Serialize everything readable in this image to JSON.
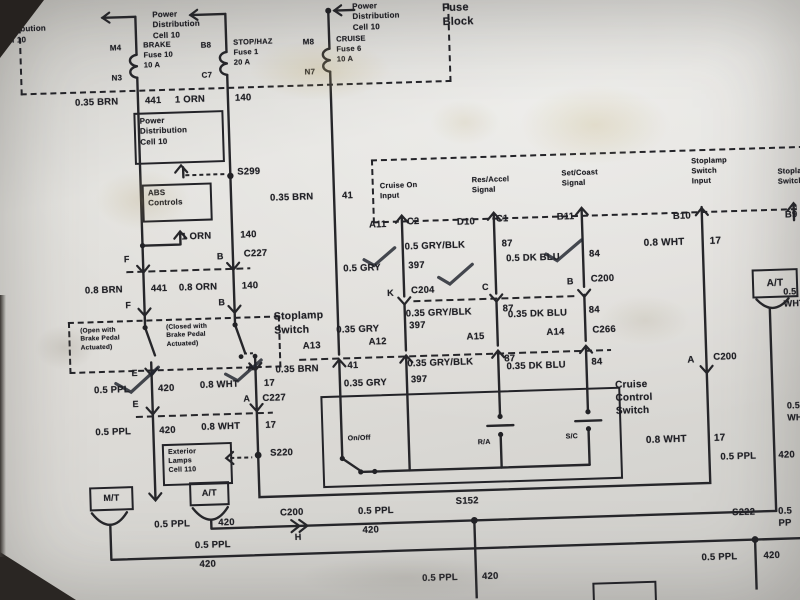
{
  "title": "Brake / Cruise Control wiring diagram photo",
  "boxes": {
    "pdc": "Power\nDistribution\nCell 10",
    "abs": "ABS\nControls",
    "ext": "Exterior\nLamps\nCell 110",
    "mt": "M/T",
    "at": "A/T",
    "at2": "A/T"
  },
  "labels": [
    {
      "n": "ref-power-dist-1",
      "t": "Power\nDistribution\nCell 10",
      "x": 8,
      "y": 2,
      "s": 8
    },
    {
      "n": "ref-power-dist-2",
      "t": "Power\nDistribution\nCell 10",
      "x": 162,
      "y": 2,
      "s": 8
    },
    {
      "n": "ref-power-dist-3",
      "t": "Power\nDistribution\nCell 10",
      "x": 362,
      "y": 0,
      "s": 8
    },
    {
      "n": "fuse-block-title",
      "t": "Fuse\nBlock",
      "x": 452,
      "y": 2,
      "s": 11
    },
    {
      "n": "pin-m4",
      "t": "M4",
      "x": 106,
      "y": 34,
      "s": 8,
      "a": "r",
      "w": 24
    },
    {
      "n": "fuse-brake",
      "t": "BRAKE\nFuse 10\n10 A",
      "x": 152,
      "y": 32,
      "s": 7.5
    },
    {
      "n": "pin-n3",
      "t": "N3",
      "x": 106,
      "y": 64,
      "s": 8,
      "a": "r",
      "w": 24
    },
    {
      "n": "pin-b8",
      "t": "B8",
      "x": 196,
      "y": 34,
      "s": 8,
      "a": "r",
      "w": 24
    },
    {
      "n": "fuse-stophaz",
      "t": "STOP/HAZ\nFuse 1\n20 A",
      "x": 242,
      "y": 32,
      "s": 7.5
    },
    {
      "n": "pin-c7",
      "t": "C7",
      "x": 196,
      "y": 64,
      "s": 8,
      "a": "r",
      "w": 24
    },
    {
      "n": "pin-m8",
      "t": "M8",
      "x": 299,
      "y": 34,
      "s": 8,
      "a": "r",
      "w": 24
    },
    {
      "n": "fuse-cruise",
      "t": "CRUISE\nFuse 6\n10 A",
      "x": 345,
      "y": 32,
      "s": 7.5
    },
    {
      "n": "pin-n7",
      "t": "N7",
      "x": 299,
      "y": 64,
      "s": 8,
      "a": "r",
      "w": 24
    },
    {
      "n": "wire-brn-035-441",
      "t": "0.35 BRN",
      "x": 82,
      "y": 87,
      "s": 9.5
    },
    {
      "n": "cir-441-a",
      "t": "441",
      "x": 152,
      "y": 87,
      "s": 9.5
    },
    {
      "n": "wire-orn-1a",
      "t": "1 ORN",
      "x": 182,
      "y": 87,
      "s": 9.5
    },
    {
      "n": "cir-140-a",
      "t": "140",
      "x": 242,
      "y": 87,
      "s": 9.5
    },
    {
      "n": "wire-brn-035-41a",
      "t": "0.35 BRN",
      "x": 274,
      "y": 188,
      "s": 9.5
    },
    {
      "n": "cir-41-a",
      "t": "41",
      "x": 346,
      "y": 188,
      "s": 9.5
    },
    {
      "n": "splice-s299",
      "t": "S299",
      "x": 242,
      "y": 161,
      "s": 9.5
    },
    {
      "n": "wire-orn-1b",
      "t": "1 ORN",
      "x": 184,
      "y": 224,
      "s": 9.5
    },
    {
      "n": "cir-140-b",
      "t": "140",
      "x": 243,
      "y": 224,
      "s": 9.5
    },
    {
      "n": "pin-f1",
      "t": "F",
      "x": 126,
      "y": 245,
      "s": 9
    },
    {
      "n": "pin-b1",
      "t": "B",
      "x": 219,
      "y": 245,
      "s": 9
    },
    {
      "n": "conn-c227-a",
      "t": "C227",
      "x": 246,
      "y": 243,
      "s": 9.5
    },
    {
      "n": "wire-brn-08",
      "t": "0.8 BRN",
      "x": 86,
      "y": 275,
      "s": 9.5
    },
    {
      "n": "cir-441-b",
      "t": "441",
      "x": 152,
      "y": 275,
      "s": 9.5
    },
    {
      "n": "wire-orn-08",
      "t": "0.8 ORN",
      "x": 180,
      "y": 275,
      "s": 9.5
    },
    {
      "n": "cir-140-c",
      "t": "140",
      "x": 243,
      "y": 275,
      "s": 9.5
    },
    {
      "n": "pin-f2",
      "t": "F",
      "x": 126,
      "y": 291,
      "s": 9
    },
    {
      "n": "pin-b2",
      "t": "B",
      "x": 219,
      "y": 291,
      "s": 9
    },
    {
      "n": "stoplamp-switch-title",
      "t": "Stoplamp\nSwitch",
      "x": 274,
      "y": 306,
      "s": 10.5
    },
    {
      "n": "note-open",
      "t": "(Open with\nBrake Pedal\nActuated)",
      "x": 80,
      "y": 317,
      "s": 6.5
    },
    {
      "n": "note-closed",
      "t": "(Closed with\nBrake Pedal\nActuated)",
      "x": 166,
      "y": 316,
      "s": 6.5
    },
    {
      "n": "pin-e1",
      "t": "E",
      "x": 130,
      "y": 359,
      "s": 9
    },
    {
      "n": "pin-a1",
      "t": "A",
      "x": 246,
      "y": 357,
      "s": 9
    },
    {
      "n": "wire-ppl-05a",
      "t": "0.5 PPL",
      "x": 92,
      "y": 375,
      "s": 9.5
    },
    {
      "n": "cir-420-a",
      "t": "420",
      "x": 156,
      "y": 375,
      "s": 9.5
    },
    {
      "n": "wire-wht-08a",
      "t": "0.8 WHT",
      "x": 198,
      "y": 373,
      "s": 9.5
    },
    {
      "n": "cir-17-a",
      "t": "17",
      "x": 262,
      "y": 373,
      "s": 9.5
    },
    {
      "n": "pin-e2",
      "t": "E",
      "x": 130,
      "y": 390,
      "s": 9
    },
    {
      "n": "pin-a2",
      "t": "A",
      "x": 241,
      "y": 388,
      "s": 9
    },
    {
      "n": "conn-c227-b",
      "t": "C227",
      "x": 260,
      "y": 388,
      "s": 9.5
    },
    {
      "n": "wire-ppl-05b",
      "t": "0.5 PPL",
      "x": 92,
      "y": 417,
      "s": 9.5
    },
    {
      "n": "cir-420-b",
      "t": "420",
      "x": 156,
      "y": 417,
      "s": 9.5
    },
    {
      "n": "wire-wht-08b",
      "t": "0.8 WHT",
      "x": 198,
      "y": 415,
      "s": 9.5
    },
    {
      "n": "cir-17-b",
      "t": "17",
      "x": 262,
      "y": 415,
      "s": 9.5
    },
    {
      "n": "splice-s220",
      "t": "S220",
      "x": 266,
      "y": 443,
      "s": 9.5
    },
    {
      "n": "input-cruise-on",
      "t": "Cruise On\nInput",
      "x": 384,
      "y": 180,
      "s": 7.5
    },
    {
      "n": "input-res-accel",
      "t": "Res/Accel\nSignal",
      "x": 476,
      "y": 177,
      "s": 7.5
    },
    {
      "n": "input-set-coast",
      "t": "Set/Coast\nSignal",
      "x": 566,
      "y": 173,
      "s": 7.5
    },
    {
      "n": "input-stoplamp",
      "t": "Stoplamp\nSwitch\nInput",
      "x": 696,
      "y": 165,
      "s": 7.5
    },
    {
      "n": "input-stoplamp-cut",
      "t": "Stoplamp\nSwitch",
      "x": 782,
      "y": 178,
      "s": 7.5
    },
    {
      "n": "pin-a11",
      "t": "A11",
      "x": 372,
      "y": 218,
      "s": 9.5
    },
    {
      "n": "pin-c2",
      "t": "C2",
      "x": 410,
      "y": 216,
      "s": 9.5
    },
    {
      "n": "pin-d10",
      "t": "D10",
      "x": 460,
      "y": 218,
      "s": 9.5
    },
    {
      "n": "pin-c1",
      "t": "C1",
      "x": 499,
      "y": 216,
      "s": 9.5
    },
    {
      "n": "pin-b11",
      "t": "B11",
      "x": 560,
      "y": 216,
      "s": 9.5
    },
    {
      "n": "pin-b10",
      "t": "B10",
      "x": 676,
      "y": 219,
      "s": 9.5
    },
    {
      "n": "pin-b9-cut",
      "t": "B9",
      "x": 788,
      "y": 221,
      "s": 9.5
    },
    {
      "n": "wire-gryblk-05",
      "t": "0.5 GRY/BLK",
      "x": 407,
      "y": 241,
      "s": 9.5
    },
    {
      "n": "cir-87-a",
      "t": "87",
      "x": 504,
      "y": 241,
      "s": 9.5
    },
    {
      "n": "wire-gry-05",
      "t": "0.5 GRY",
      "x": 345,
      "y": 261,
      "s": 9.5
    },
    {
      "n": "cir-397-a",
      "t": "397",
      "x": 410,
      "y": 260,
      "s": 9.5
    },
    {
      "n": "wire-dkblu-05",
      "t": "0.5 DK BLU",
      "x": 508,
      "y": 256,
      "s": 9.5
    },
    {
      "n": "cir-84-a",
      "t": "84",
      "x": 591,
      "y": 254,
      "s": 9.5
    },
    {
      "n": "pin-k",
      "t": "K",
      "x": 388,
      "y": 287,
      "s": 9
    },
    {
      "n": "conn-c204",
      "t": "C204",
      "x": 412,
      "y": 285,
      "s": 9.5
    },
    {
      "n": "pin-c",
      "t": "C",
      "x": 483,
      "y": 284,
      "s": 9
    },
    {
      "n": "pin-b3",
      "t": "B",
      "x": 568,
      "y": 281,
      "s": 9
    },
    {
      "n": "conn-c200-a",
      "t": "C200",
      "x": 592,
      "y": 279,
      "s": 9.5
    },
    {
      "n": "wire-gryblk-035a",
      "t": "0.35 GRY/BLK",
      "x": 406,
      "y": 308,
      "s": 9.5
    },
    {
      "n": "cir-87-b",
      "t": "87",
      "x": 503,
      "y": 306,
      "s": 9.5
    },
    {
      "n": "wire-gry-035a",
      "t": "0.35 GRY",
      "x": 336,
      "y": 322,
      "s": 9.5
    },
    {
      "n": "cir-397-b",
      "t": "397",
      "x": 409,
      "y": 320,
      "s": 9.5
    },
    {
      "n": "wire-dkblu-035a",
      "t": "0.35 DK BLU",
      "x": 508,
      "y": 312,
      "s": 9.5
    },
    {
      "n": "cir-84-b",
      "t": "84",
      "x": 589,
      "y": 310,
      "s": 9.5
    },
    {
      "n": "pin-a13",
      "t": "A13",
      "x": 302,
      "y": 337,
      "s": 9.5
    },
    {
      "n": "pin-a12",
      "t": "A12",
      "x": 368,
      "y": 335,
      "s": 9.5
    },
    {
      "n": "pin-a15",
      "t": "A15",
      "x": 466,
      "y": 333,
      "s": 9.5
    },
    {
      "n": "pin-a14",
      "t": "A14",
      "x": 546,
      "y": 331,
      "s": 9.5
    },
    {
      "n": "conn-c266",
      "t": "C266",
      "x": 592,
      "y": 330,
      "s": 9.5
    },
    {
      "n": "wire-brn-035-41b",
      "t": "0.35 BRN",
      "x": 274,
      "y": 360,
      "s": 9.5
    },
    {
      "n": "cir-41-b",
      "t": "41",
      "x": 346,
      "y": 358,
      "s": 9.5
    },
    {
      "n": "wire-gry-035b",
      "t": "0.35 GRY",
      "x": 342,
      "y": 376,
      "s": 9.5
    },
    {
      "n": "cir-397-c",
      "t": "397",
      "x": 409,
      "y": 374,
      "s": 9.5
    },
    {
      "n": "wire-gryblk-035b",
      "t": "0.35 GRY/BLK",
      "x": 406,
      "y": 358,
      "s": 9.5
    },
    {
      "n": "cir-87-c",
      "t": "87",
      "x": 503,
      "y": 356,
      "s": 9.5
    },
    {
      "n": "wire-dkblu-035b",
      "t": "0.35 DK BLU",
      "x": 505,
      "y": 364,
      "s": 9.5
    },
    {
      "n": "cir-84-c",
      "t": "84",
      "x": 590,
      "y": 362,
      "s": 9.5
    },
    {
      "n": "sw-onoff",
      "t": "On/Off",
      "x": 344,
      "y": 432,
      "s": 7
    },
    {
      "n": "sw-ra",
      "t": "R/A",
      "x": 474,
      "y": 440,
      "s": 7
    },
    {
      "n": "sw-sc",
      "t": "S/C",
      "x": 562,
      "y": 437,
      "s": 7
    },
    {
      "n": "cruise-switch-title",
      "t": "Cruise\nControl\nSwitch",
      "x": 613,
      "y": 385,
      "s": 10
    },
    {
      "n": "wire-wht-08c",
      "t": "0.8 WHT",
      "x": 646,
      "y": 244,
      "s": 10
    },
    {
      "n": "cir-17-c",
      "t": "17",
      "x": 712,
      "y": 244,
      "s": 10
    },
    {
      "n": "pin-a3",
      "t": "A",
      "x": 686,
      "y": 363,
      "s": 9.5
    },
    {
      "n": "conn-c200-b",
      "t": "C200",
      "x": 712,
      "y": 361,
      "s": 9.5
    },
    {
      "n": "wire-wht-08d",
      "t": "0.8 WHT",
      "x": 642,
      "y": 441,
      "s": 10
    },
    {
      "n": "cir-17-d",
      "t": "17",
      "x": 710,
      "y": 441,
      "s": 10
    },
    {
      "n": "wire-wht-cut-a",
      "t": "0.5\nWHT",
      "x": 784,
      "y": 298,
      "s": 9
    },
    {
      "n": "wire-wht-cut-b",
      "t": "0.5\nWHT",
      "x": 784,
      "y": 412,
      "s": 9
    },
    {
      "n": "wire-ppl-at",
      "t": "0.5 PPL",
      "x": 716,
      "y": 461,
      "s": 9.5
    },
    {
      "n": "cir-420-at",
      "t": "420",
      "x": 774,
      "y": 461,
      "s": 9.5
    },
    {
      "n": "wire-ppl-w1a",
      "t": "0.5 PPL",
      "x": 148,
      "y": 511,
      "s": 9.5
    },
    {
      "n": "cir-420-w1a",
      "t": "420",
      "x": 212,
      "y": 511,
      "s": 9.5
    },
    {
      "n": "conn-c200-h",
      "t": "C200",
      "x": 274,
      "y": 503,
      "s": 9.5
    },
    {
      "n": "pin-h",
      "t": "H",
      "x": 288,
      "y": 528,
      "s": 9
    },
    {
      "n": "wire-ppl-w1b",
      "t": "0.5 PPL",
      "x": 352,
      "y": 504,
      "s": 9.5
    },
    {
      "n": "cir-420-w1b",
      "t": "420",
      "x": 356,
      "y": 523,
      "s": 9.5
    },
    {
      "n": "splice-s152",
      "t": "S152",
      "x": 450,
      "y": 497,
      "s": 9.5
    },
    {
      "n": "wire-ppl-w2",
      "t": "0.5 PPL",
      "x": 188,
      "y": 533,
      "s": 9.5
    },
    {
      "n": "cir-420-w2",
      "t": "420",
      "x": 192,
      "y": 552,
      "s": 9.5
    },
    {
      "n": "wire-ppl-s152",
      "t": "0.5 PPL",
      "x": 414,
      "y": 573,
      "s": 9.5
    },
    {
      "n": "cir-420-s152",
      "t": "420",
      "x": 474,
      "y": 573,
      "s": 9.5
    },
    {
      "n": "splice-s222",
      "t": "S222",
      "x": 726,
      "y": 517,
      "s": 9.5
    },
    {
      "n": "wire-ppl-cut",
      "t": "0.5 PP",
      "x": 772,
      "y": 517,
      "s": 9.5
    },
    {
      "n": "wire-ppl-s222",
      "t": "0.5 PPL",
      "x": 694,
      "y": 561,
      "s": 9.5
    },
    {
      "n": "cir-420-s222",
      "t": "420",
      "x": 756,
      "y": 561,
      "s": 9.5
    }
  ]
}
